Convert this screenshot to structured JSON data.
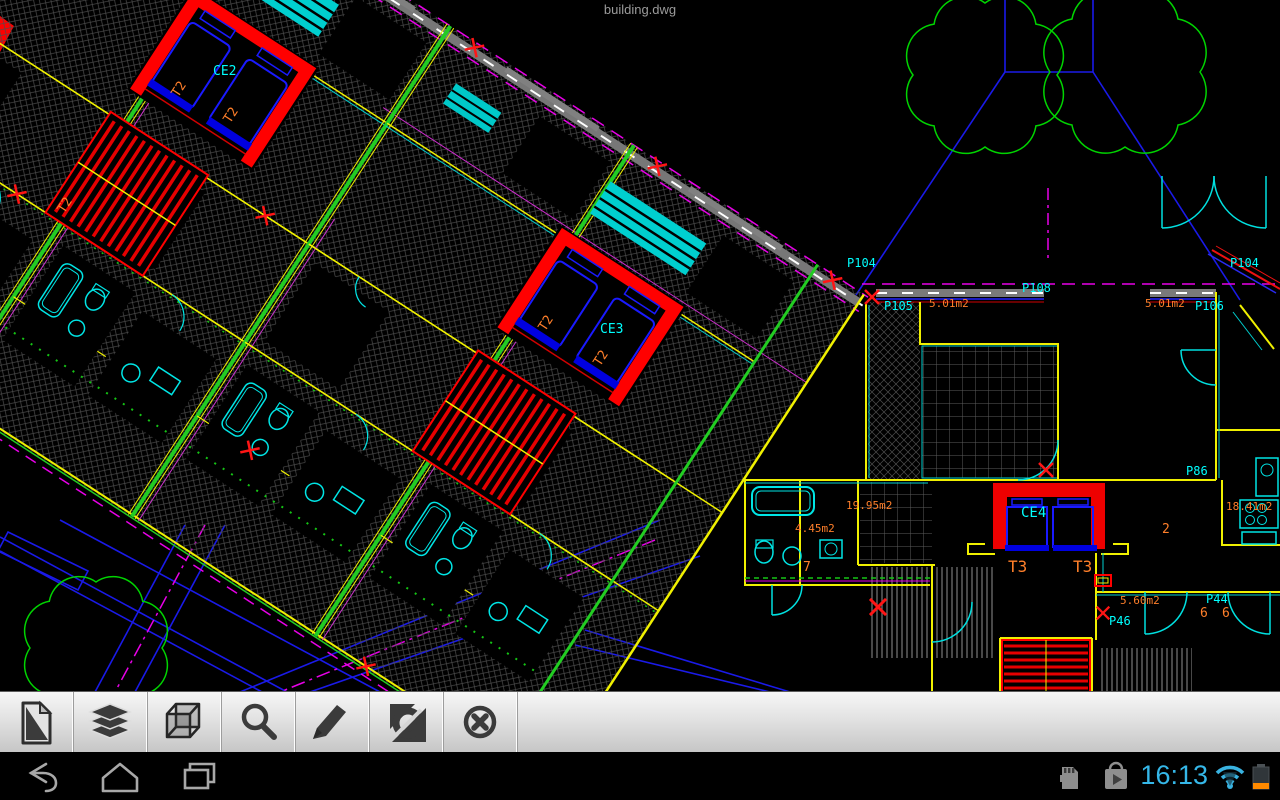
{
  "window": {
    "title": "building.dwg"
  },
  "toolbar": {
    "buttons": [
      {
        "id": "file",
        "icon": "file-icon"
      },
      {
        "id": "layers",
        "icon": "layers-icon"
      },
      {
        "id": "view-3d",
        "icon": "cube-icon"
      },
      {
        "id": "zoom",
        "icon": "magnifier-icon"
      },
      {
        "id": "edit",
        "icon": "pencil-icon"
      },
      {
        "id": "views",
        "icon": "orbit-icon"
      },
      {
        "id": "close",
        "icon": "close-icon"
      }
    ]
  },
  "navbar": {
    "time": "16:13",
    "icons": [
      "back",
      "home",
      "recent-apps",
      "sd-card",
      "play-store",
      "wifi",
      "battery"
    ]
  },
  "drawing": {
    "colors": {
      "cyan": "#00ffff",
      "orange": "#ff7f2a",
      "red": "#ff0000",
      "green": "#00d400",
      "blue": "#1a1ae8",
      "magenta": "#e800e8",
      "hatch": "#4d4d4d",
      "sill": "#7a7a7a",
      "holo_blue": "#33b5e5"
    },
    "labels": [
      {
        "t": "CE2",
        "x": 213,
        "y": 75,
        "c": "cyan",
        "s": 13
      },
      {
        "t": "CE3",
        "x": 600,
        "y": 333,
        "c": "cyan",
        "s": 13
      },
      {
        "t": "CE4",
        "x": 1021,
        "y": 517,
        "c": "cyan",
        "s": 14
      },
      {
        "t": "T2",
        "x": 178,
        "y": 98,
        "c": "orange",
        "s": 13,
        "r": -57
      },
      {
        "t": "T2",
        "x": 230,
        "y": 124,
        "c": "orange",
        "s": 13,
        "r": -57
      },
      {
        "t": "T2",
        "x": 64,
        "y": 214,
        "c": "orange",
        "s": 13,
        "r": -57
      },
      {
        "t": "T2",
        "x": 545,
        "y": 332,
        "c": "orange",
        "s": 13,
        "r": -57
      },
      {
        "t": "T2",
        "x": 600,
        "y": 367,
        "c": "orange",
        "s": 13,
        "r": -57
      },
      {
        "t": "T3",
        "x": 1008,
        "y": 572,
        "c": "orange",
        "s": 16
      },
      {
        "t": "T3",
        "x": 1073,
        "y": 572,
        "c": "orange",
        "s": 16
      },
      {
        "t": "P104",
        "x": 847,
        "y": 267,
        "c": "cyan",
        "s": 12
      },
      {
        "t": "P104",
        "x": 1230,
        "y": 267,
        "c": "cyan",
        "s": 12
      },
      {
        "t": "P108",
        "x": 1022,
        "y": 292,
        "c": "cyan",
        "s": 12
      },
      {
        "t": "P105",
        "x": 884,
        "y": 310,
        "c": "cyan",
        "s": 12
      },
      {
        "t": "P106",
        "x": 1195,
        "y": 310,
        "c": "cyan",
        "s": 12
      },
      {
        "t": "P86",
        "x": 1186,
        "y": 475,
        "c": "cyan",
        "s": 12
      },
      {
        "t": "P44",
        "x": 1206,
        "y": 603,
        "c": "cyan",
        "s": 12
      },
      {
        "t": "P46",
        "x": 1109,
        "y": 625,
        "c": "cyan",
        "s": 12
      },
      {
        "t": "5.01m2",
        "x": 929,
        "y": 307,
        "c": "orange",
        "s": 11
      },
      {
        "t": "5.01m2",
        "x": 1145,
        "y": 307,
        "c": "orange",
        "s": 11
      },
      {
        "t": "18.41m2",
        "x": 1226,
        "y": 510,
        "c": "orange",
        "s": 11
      },
      {
        "t": "19.95m2",
        "x": 846,
        "y": 509,
        "c": "orange",
        "s": 11
      },
      {
        "t": "4.45m2",
        "x": 795,
        "y": 532,
        "c": "orange",
        "s": 11
      },
      {
        "t": "5.60m2",
        "x": 1120,
        "y": 604,
        "c": "orange",
        "s": 11
      },
      {
        "t": "7",
        "x": 803,
        "y": 571,
        "c": "orange",
        "s": 13
      },
      {
        "t": "2",
        "x": 1162,
        "y": 533,
        "c": "orange",
        "s": 13
      },
      {
        "t": "6",
        "x": 1200,
        "y": 617,
        "c": "orange",
        "s": 13
      },
      {
        "t": "6",
        "x": 1222,
        "y": 617,
        "c": "orange",
        "s": 13
      }
    ]
  }
}
